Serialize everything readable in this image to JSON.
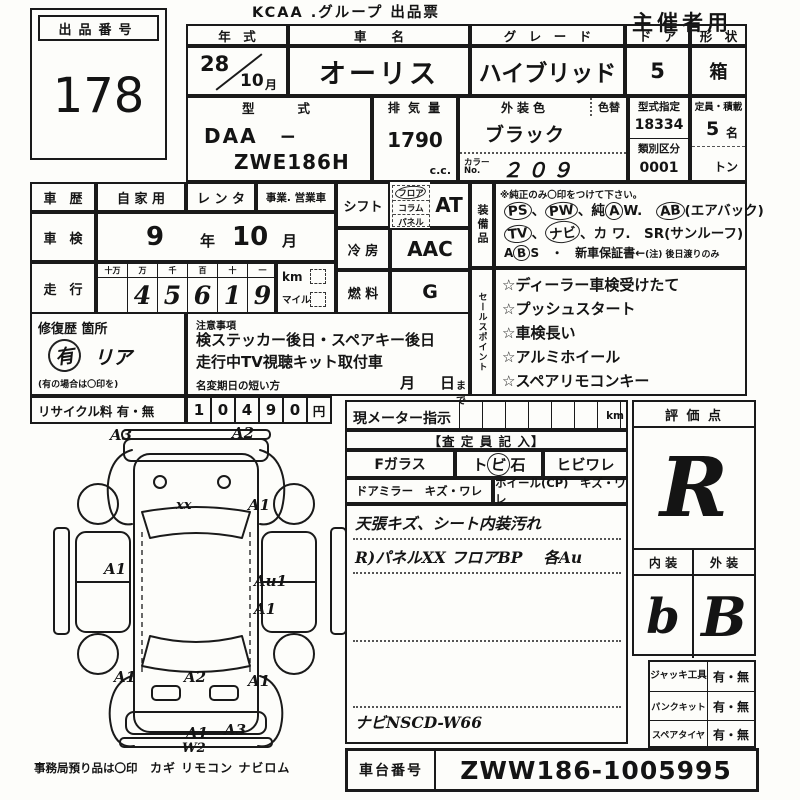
{
  "meta": {
    "title": "KCAA .グループ 出品票",
    "audience": "主催者用"
  },
  "lot": {
    "label": "出品番号",
    "number": "178"
  },
  "spec": {
    "year_label": "年　式",
    "year": "28",
    "month": "10",
    "month_unit": "月",
    "name_label": "車　　名",
    "name": "オーリス",
    "grade_label": "グ　レ　ー　ド",
    "grade": "ハイブリッド",
    "door_label": "ド　ア",
    "door": "5",
    "shape_label": "形　状",
    "shape": "箱",
    "model_label": "型　　式",
    "model1": "DAA　−",
    "model2": "ZWE186H",
    "disp_label": "排 気 量",
    "disp": "1790",
    "disp_unit": "c.c.",
    "color_label": "外装色",
    "color": "ブラック",
    "color_change_label": "色替",
    "color_no_label1": "カラー",
    "color_no_label2": "No.",
    "color_no": "２０９",
    "type_label": "型式指定",
    "type_no": "18334",
    "class_label": "類別区分",
    "class_no": "0001",
    "cap_label": "定員・積載",
    "cap": "5",
    "cap_unit": "名",
    "load_unit": "トン"
  },
  "history": {
    "label": "車　歴",
    "own": "自 家 用",
    "rental": "レ ン タ",
    "business": "事業. 営業車"
  },
  "shaken": {
    "label": "車　検",
    "year": "9",
    "year_unit": "年",
    "month": "10",
    "month_unit": "月"
  },
  "mileage": {
    "label": "走　行",
    "headers": [
      "十万",
      "万",
      "千",
      "百",
      "十",
      "一"
    ],
    "digits": [
      "",
      "4",
      "5",
      "6",
      "1",
      "9"
    ],
    "km": "km",
    "mile": "マイル"
  },
  "shift": {
    "label": "シフト",
    "floor": "フロア",
    "column": "コラム",
    "panel": "パネル",
    "value": "AT"
  },
  "cooling": {
    "label": "冷 房",
    "value": "AAC"
  },
  "fuel": {
    "label": "燃 料",
    "value": "G"
  },
  "equip": {
    "label": "装備品",
    "note": "※純正のみ〇印をつけて下さい。",
    "r1": [
      {
        "text": "PS",
        "cls": "circ"
      },
      {
        "text": "、"
      },
      {
        "text": "PW",
        "cls": "circ"
      },
      {
        "text": "、純"
      },
      {
        "text": "A",
        "cls": "circ"
      },
      {
        "text": "W.　"
      },
      {
        "text": "AB",
        "cls": "circ"
      },
      {
        "text": "(エアバック)"
      }
    ],
    "r2": [
      {
        "text": "TV",
        "cls": "circ"
      },
      {
        "text": "、"
      },
      {
        "text": "ナビ",
        "cls": "circ"
      },
      {
        "text": "、カ ワ.　SR(サンルーフ)"
      }
    ],
    "r3": [
      {
        "text": "A"
      },
      {
        "text": "B",
        "cls": "circ"
      },
      {
        "text": "S　・　新車保証書←"
      },
      {
        "text": "(注) 後日渡りのみ",
        "cls": "sm"
      }
    ]
  },
  "sales": {
    "label": "セールスポイント",
    "items": [
      "☆ディーラー車検受けたて",
      "☆プッシュスタート",
      "☆車検長い",
      "☆アルミホイール",
      "☆スペアリモコンキー"
    ]
  },
  "repair": {
    "label": "修復歴 箇所",
    "mark": "有",
    "note": "リア",
    "hint": "(有の場合は〇印を)"
  },
  "notice": {
    "label": "注意事項",
    "line1": "検ステッカー後日・スペアキー後日",
    "line2": "走行中TV視聴キット取付車",
    "deadline_label": "名変期日の短い方",
    "month": "月",
    "day": "日",
    "made": "まで"
  },
  "recycle": {
    "label": "リサイクル料 有・無",
    "digits": [
      "1",
      "0",
      "4",
      "9",
      "0"
    ],
    "unit": "円"
  },
  "diagram": {
    "marks": [
      "A3",
      "A2",
      "xx",
      "A1",
      "A1",
      "Au1",
      "A1",
      "A1",
      "A2",
      "A1",
      "A1",
      "W2",
      "A3"
    ],
    "office": "事務局預り品は〇印",
    "office_items": "カギ リモコン ナビロム"
  },
  "meter": {
    "label": "現メーター指示",
    "unit": "km"
  },
  "assessor": {
    "header": "【査 定 員 記 入】",
    "fglass": "Fガラス",
    "stone1": "ト",
    "stone2": "ビ",
    "stone3": "石",
    "crack": "ヒビワレ",
    "mirror": "ドアミラー　キズ・ワレ",
    "wheel": "ホイール(CP)　キズ・ワレ",
    "note1": "天張キズ、シート内装汚れ",
    "note2": "R)パネルXX フロアBP　 各Au",
    "note3": "ナビNSCD-W66"
  },
  "score": {
    "label": "評 価 点",
    "value": "R",
    "interior_label": "内 装",
    "exterior_label": "外 装",
    "interior": "b",
    "exterior": "B"
  },
  "tools": {
    "jack_label": "ジャッキ工具",
    "jack_value": "有・無",
    "pank_label": "パンクキット",
    "pank_value": "有・無",
    "spare_label": "スペアタイヤ",
    "spare_value": "有・無"
  },
  "chassis": {
    "label": "車台番号",
    "value": "ZWW186-1005995"
  }
}
